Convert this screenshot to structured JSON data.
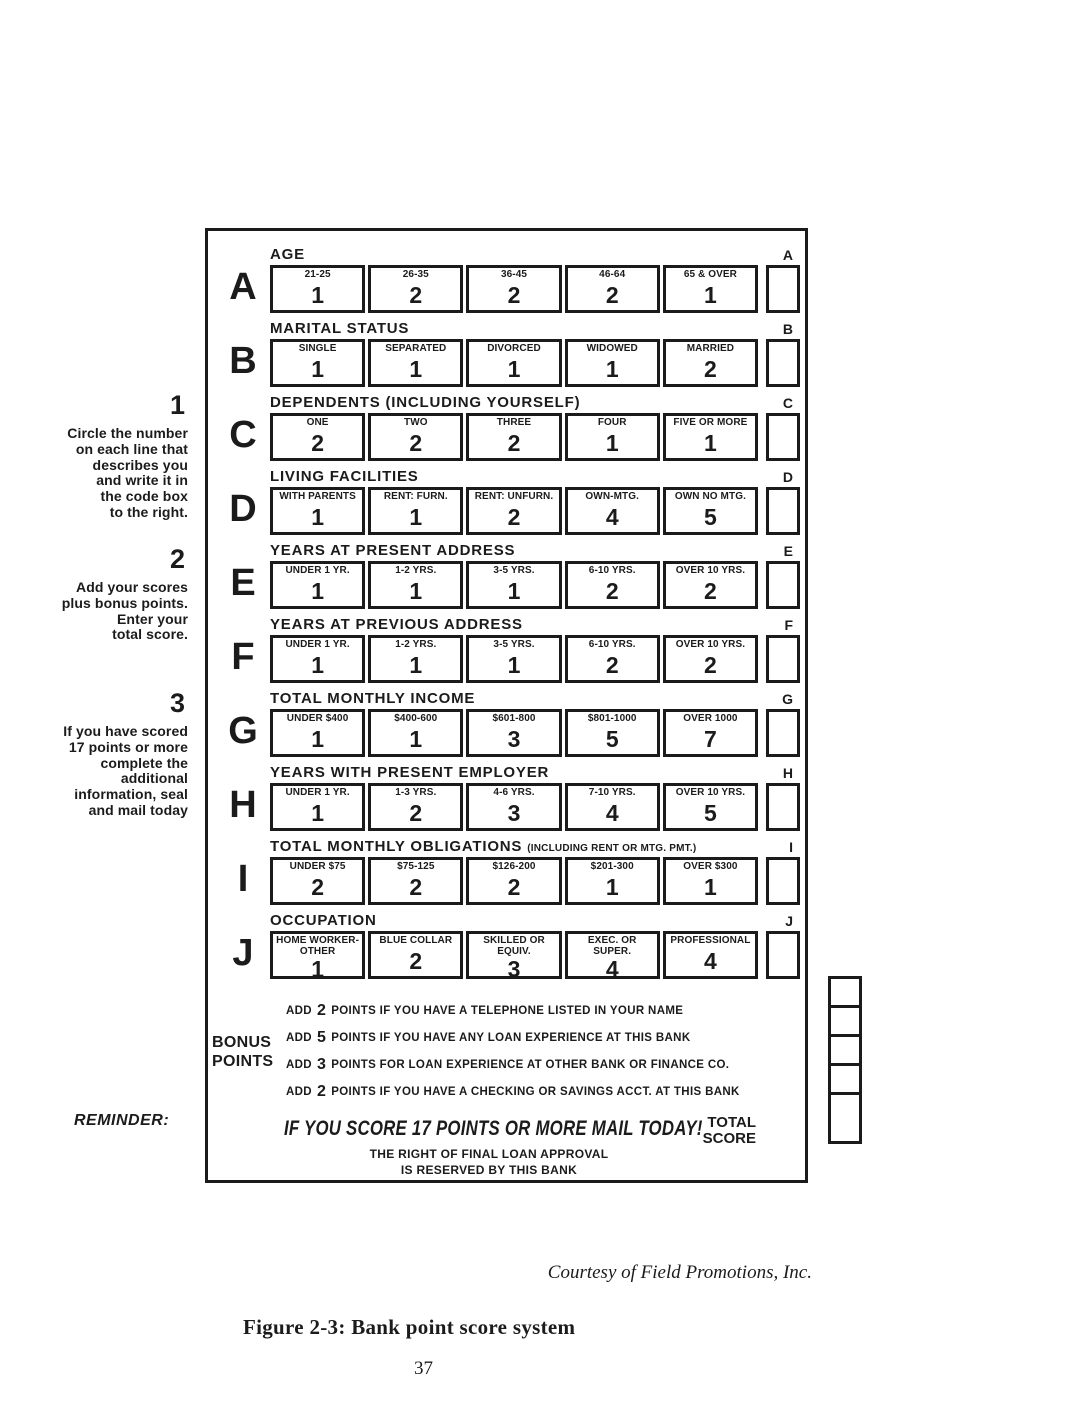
{
  "colors": {
    "ink": "#1b1b1b",
    "paper": "#ffffff"
  },
  "steps": [
    {
      "number": "1",
      "text": "Circle the number\non each line that\ndescribes you\nand write it in\nthe code box\nto the right."
    },
    {
      "number": "2",
      "text": "Add your scores\nplus bonus points.\nEnter your\ntotal score."
    },
    {
      "number": "3",
      "text": "If you have scored\n17 points or more\ncomplete the\nadditional\ninformation, seal\nand mail today"
    }
  ],
  "form": {
    "sections": [
      {
        "letter": "A",
        "code": "A",
        "title": "AGE",
        "note": "",
        "cells": [
          {
            "label": "21-25",
            "value": "1"
          },
          {
            "label": "26-35",
            "value": "2"
          },
          {
            "label": "36-45",
            "value": "2"
          },
          {
            "label": "46-64",
            "value": "2"
          },
          {
            "label": "65 & OVER",
            "value": "1"
          }
        ]
      },
      {
        "letter": "B",
        "code": "B",
        "title": "MARITAL STATUS",
        "note": "",
        "cells": [
          {
            "label": "SINGLE",
            "value": "1"
          },
          {
            "label": "SEPARATED",
            "value": "1"
          },
          {
            "label": "DIVORCED",
            "value": "1"
          },
          {
            "label": "WIDOWED",
            "value": "1"
          },
          {
            "label": "MARRIED",
            "value": "2"
          }
        ]
      },
      {
        "letter": "C",
        "code": "C",
        "title": "DEPENDENTS (INCLUDING YOURSELF)",
        "note": "",
        "cells": [
          {
            "label": "ONE",
            "value": "2"
          },
          {
            "label": "TWO",
            "value": "2"
          },
          {
            "label": "THREE",
            "value": "2"
          },
          {
            "label": "FOUR",
            "value": "1"
          },
          {
            "label": "FIVE OR MORE",
            "value": "1"
          }
        ]
      },
      {
        "letter": "D",
        "code": "D",
        "title": "LIVING FACILITIES",
        "note": "",
        "cells": [
          {
            "label": "WITH PARENTS",
            "value": "1"
          },
          {
            "label": "RENT: FURN.",
            "value": "1"
          },
          {
            "label": "RENT: UNFURN.",
            "value": "2"
          },
          {
            "label": "OWN-MTG.",
            "value": "4"
          },
          {
            "label": "OWN NO MTG.",
            "value": "5"
          }
        ]
      },
      {
        "letter": "E",
        "code": "E",
        "title": "YEARS AT PRESENT ADDRESS",
        "note": "",
        "cells": [
          {
            "label": "UNDER 1 YR.",
            "value": "1"
          },
          {
            "label": "1-2 YRS.",
            "value": "1"
          },
          {
            "label": "3-5 YRS.",
            "value": "1"
          },
          {
            "label": "6-10 YRS.",
            "value": "2"
          },
          {
            "label": "OVER 10 YRS.",
            "value": "2"
          }
        ]
      },
      {
        "letter": "F",
        "code": "F",
        "title": "YEARS AT PREVIOUS ADDRESS",
        "note": "",
        "cells": [
          {
            "label": "UNDER 1 YR.",
            "value": "1"
          },
          {
            "label": "1-2 YRS.",
            "value": "1"
          },
          {
            "label": "3-5 YRS.",
            "value": "1"
          },
          {
            "label": "6-10 YRS.",
            "value": "2"
          },
          {
            "label": "OVER 10 YRS.",
            "value": "2"
          }
        ]
      },
      {
        "letter": "G",
        "code": "G",
        "title": "TOTAL MONTHLY INCOME",
        "note": "",
        "cells": [
          {
            "label": "UNDER $400",
            "value": "1"
          },
          {
            "label": "$400-600",
            "value": "1"
          },
          {
            "label": "$601-800",
            "value": "3"
          },
          {
            "label": "$801-1000",
            "value": "5"
          },
          {
            "label": "OVER 1000",
            "value": "7"
          }
        ]
      },
      {
        "letter": "H",
        "code": "H",
        "title": "YEARS WITH PRESENT EMPLOYER",
        "note": "",
        "cells": [
          {
            "label": "UNDER 1 YR.",
            "value": "1"
          },
          {
            "label": "1-3 YRS.",
            "value": "2"
          },
          {
            "label": "4-6 YRS.",
            "value": "3"
          },
          {
            "label": "7-10 YRS.",
            "value": "4"
          },
          {
            "label": "OVER 10 YRS.",
            "value": "5"
          }
        ]
      },
      {
        "letter": "I",
        "code": "I",
        "title": "TOTAL MONTHLY OBLIGATIONS",
        "note": "(INCLUDING RENT OR MTG. PMT.)",
        "cells": [
          {
            "label": "UNDER $75",
            "value": "2"
          },
          {
            "label": "$75-125",
            "value": "2"
          },
          {
            "label": "$126-200",
            "value": "2"
          },
          {
            "label": "$201-300",
            "value": "1"
          },
          {
            "label": "OVER $300",
            "value": "1"
          }
        ]
      },
      {
        "letter": "J",
        "code": "J",
        "title": "OCCUPATION",
        "note": "",
        "cells": [
          {
            "label": "HOME WORKER-\nOTHER",
            "value": "1"
          },
          {
            "label": "BLUE COLLAR",
            "value": "2"
          },
          {
            "label": "SKILLED OR\nEQUIV.",
            "value": "3"
          },
          {
            "label": "EXEC. OR\nSUPER.",
            "value": "4"
          },
          {
            "label": "PROFESSIONAL",
            "value": "4"
          }
        ]
      }
    ],
    "bonus": {
      "label": "BONUS\nPOINTS",
      "items": [
        {
          "prefix": "ADD",
          "points": "2",
          "text": "POINTS IF YOU HAVE A TELEPHONE LISTED IN YOUR NAME"
        },
        {
          "prefix": "ADD",
          "points": "5",
          "text": "POINTS IF YOU HAVE ANY LOAN EXPERIENCE AT THIS BANK"
        },
        {
          "prefix": "ADD",
          "points": "3",
          "text": "POINTS FOR LOAN EXPERIENCE AT OTHER BANK OR FINANCE CO."
        },
        {
          "prefix": "ADD",
          "points": "2",
          "text": "POINTS IF YOU HAVE A CHECKING OR SAVINGS ACCT. AT THIS BANK"
        }
      ]
    },
    "reminder": {
      "label": "REMINDER:",
      "headline": "IF YOU SCORE 17 POINTS OR MORE MAIL TODAY!",
      "total_label": "TOTAL\nSCORE",
      "fine_print": "THE RIGHT OF FINAL LOAN APPROVAL\nIS RESERVED BY THIS BANK"
    }
  },
  "footer": {
    "courtesy": "Courtesy of Field Promotions, Inc.",
    "caption": "Figure 2-3: Bank point score system",
    "page_number": "37"
  }
}
